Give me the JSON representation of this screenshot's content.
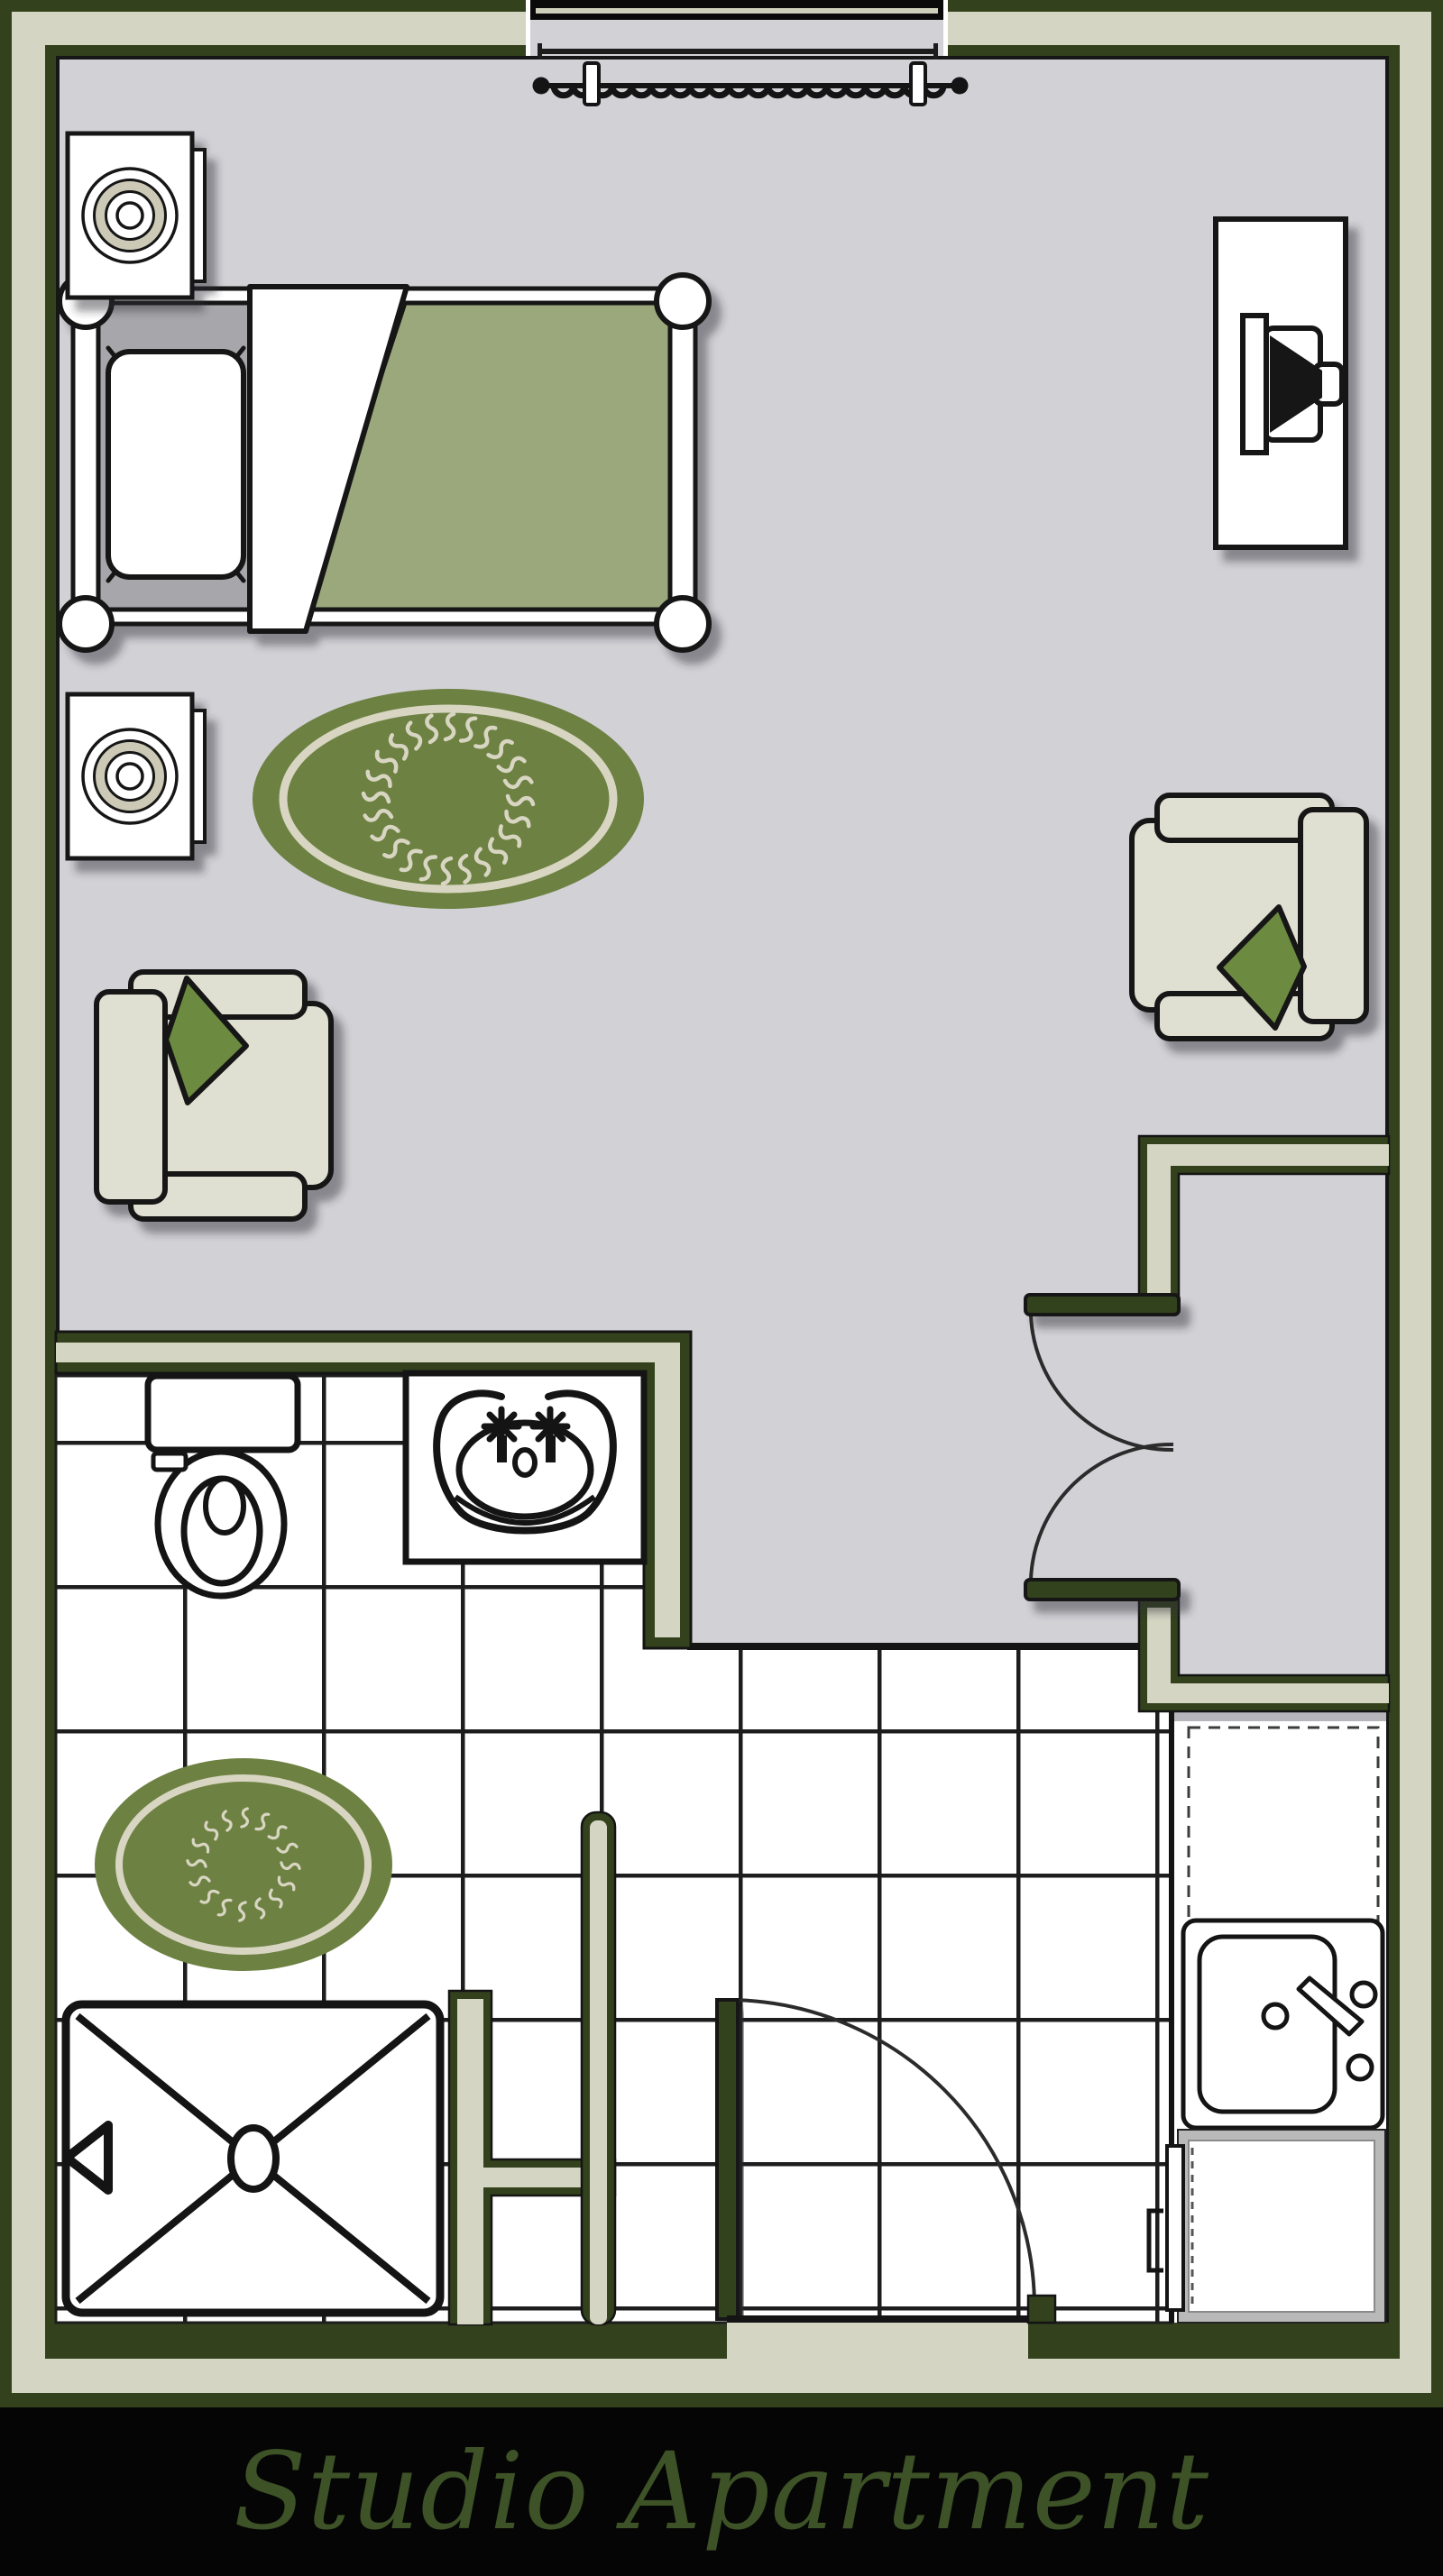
{
  "title": {
    "text": "Studio Apartment"
  },
  "palette": {
    "wall_green": "#33421c",
    "wall_cream": "#d5d5c3",
    "carpet_gray": "#d2d1d6",
    "tile_white": "#ffffff",
    "tile_line": "#1d1d1d",
    "outline_black": "#141414",
    "mattress_gray": "#a7a6ab",
    "blanket_sage": "#9ba87c",
    "rug_green": "#6d8142",
    "rug_trim_cream": "#d8d6c2",
    "chair_beige": "#e0e0d2",
    "pillow_green": "#6c8a3f",
    "appliance_gray": "#b9b9b9",
    "footer_black": "#050505",
    "title_green": "#3d5226"
  },
  "furniture_icons": [
    "bed",
    "bed-pillow",
    "folded-sheet",
    "nightstand-speaker",
    "tv-dresser",
    "armchair",
    "accent-pillow",
    "oval-rug",
    "window-curtain",
    "entry-double-door",
    "bathroom-door",
    "toilet",
    "vanity-sink",
    "shower",
    "kitchen-sink",
    "refrigerator",
    "stove"
  ]
}
